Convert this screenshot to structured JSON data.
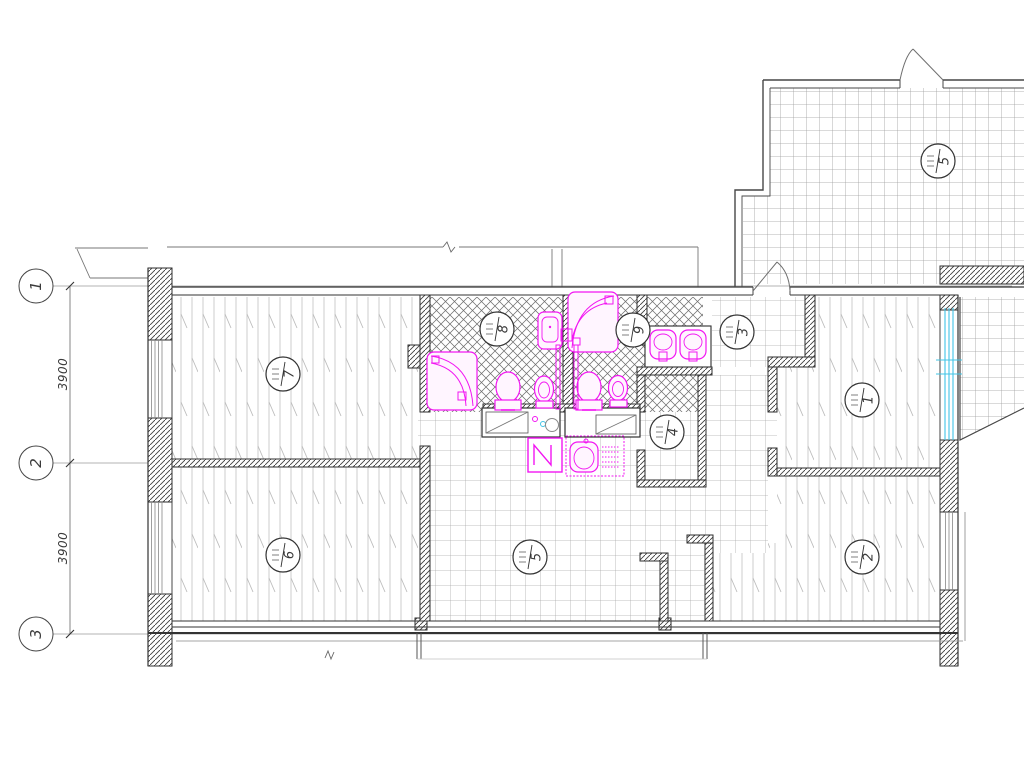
{
  "plan": {
    "title": "apartment-floor-plan",
    "grid_axes": [
      {
        "label": "1"
      },
      {
        "label": "2"
      },
      {
        "label": "3"
      }
    ],
    "dimensions": [
      {
        "label": "3900"
      },
      {
        "label": "3900"
      }
    ],
    "rooms": [
      {
        "number": "7",
        "floor": "parquet"
      },
      {
        "number": "8",
        "floor": "ceramic-diamond"
      },
      {
        "number": "9",
        "floor": "ceramic-diamond"
      },
      {
        "number": "3",
        "floor": "tile"
      },
      {
        "number": "1",
        "floor": "parquet"
      },
      {
        "number": "4",
        "floor": "tile"
      },
      {
        "number": "5",
        "floor": "tile"
      },
      {
        "number": "6",
        "floor": "parquet"
      },
      {
        "number": "2",
        "floor": "parquet"
      },
      {
        "number": "5",
        "floor": "tile-terrace"
      }
    ],
    "fixtures": [
      "corner-bathtub",
      "corner-bathtub",
      "washbasin",
      "toilet",
      "bidet",
      "toilet",
      "bidet",
      "double-washbasin",
      "kitchen-sink",
      "washing-machine",
      "cooktop-counter",
      "worktop-counter"
    ],
    "colors": {
      "fixture_magenta": "#f216f2",
      "glazing_cyan": "#41c4e6",
      "wall_line": "#333333",
      "grid_line": "#9a9a9a"
    }
  }
}
